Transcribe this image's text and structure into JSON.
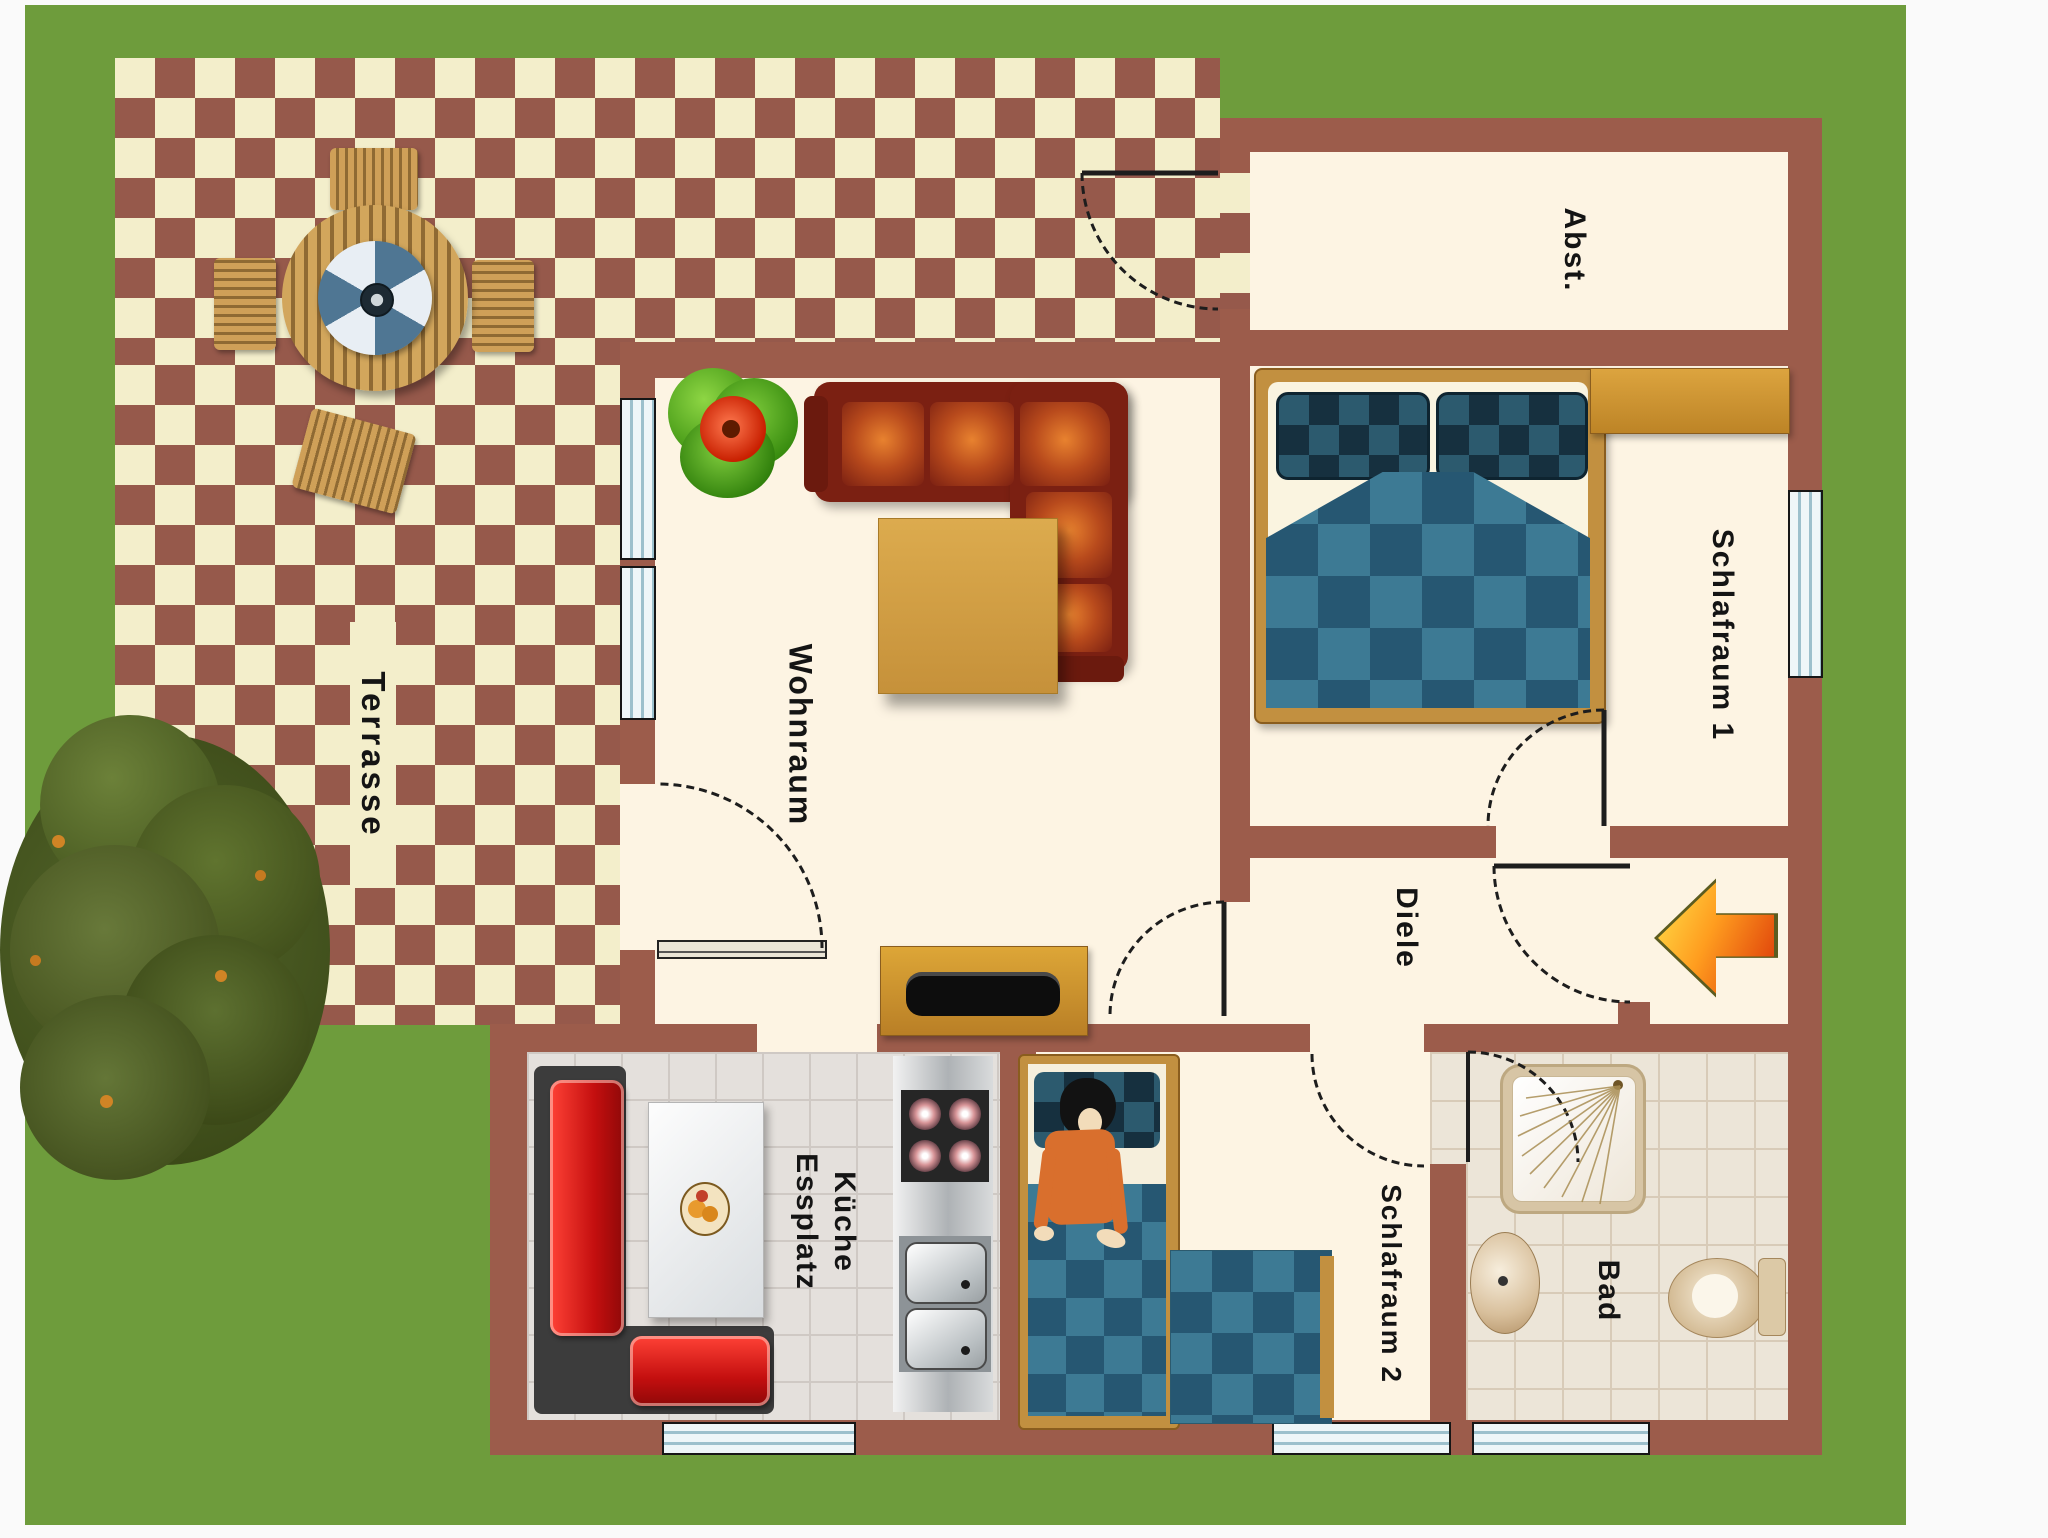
{
  "title": "apartment-floor-plan",
  "colors": {
    "lawn": "#6e9c3c",
    "wall": "#9c5c4b",
    "room_floor": "#fdf4e3",
    "terrace_brick": "#96594b",
    "terrace_cream": "#f3eecb",
    "entrance_arrow": "#f07c12",
    "bed_textile_blue": "#3d7a94",
    "bench_cushion_red": "#c40f0f"
  },
  "rooms": {
    "terrace": {
      "label": "Terrasse"
    },
    "living_room": {
      "label": "Wohnraum"
    },
    "storage": {
      "label": "Abst."
    },
    "bedroom1": {
      "label": "Schlafraum 1"
    },
    "hallway": {
      "label": "Diele"
    },
    "kitchen": {
      "label_line1": "Küche",
      "label_line2": "Essplatz"
    },
    "bedroom2": {
      "label": "Schlafraum 2"
    },
    "bathroom": {
      "label": "Bad"
    }
  },
  "furniture_icons": [
    "garden-table",
    "parasol",
    "garden-chair",
    "houseplant",
    "corner-sofa",
    "coffee-table",
    "tv-sideboard",
    "double-bed",
    "wardrobe",
    "dining-bench",
    "dining-table",
    "fruit-bowl",
    "stove",
    "kitchen-sink",
    "single-bed",
    "sleeping-person",
    "futon",
    "shower",
    "washbasin",
    "toilet",
    "tree",
    "entrance-arrow"
  ]
}
